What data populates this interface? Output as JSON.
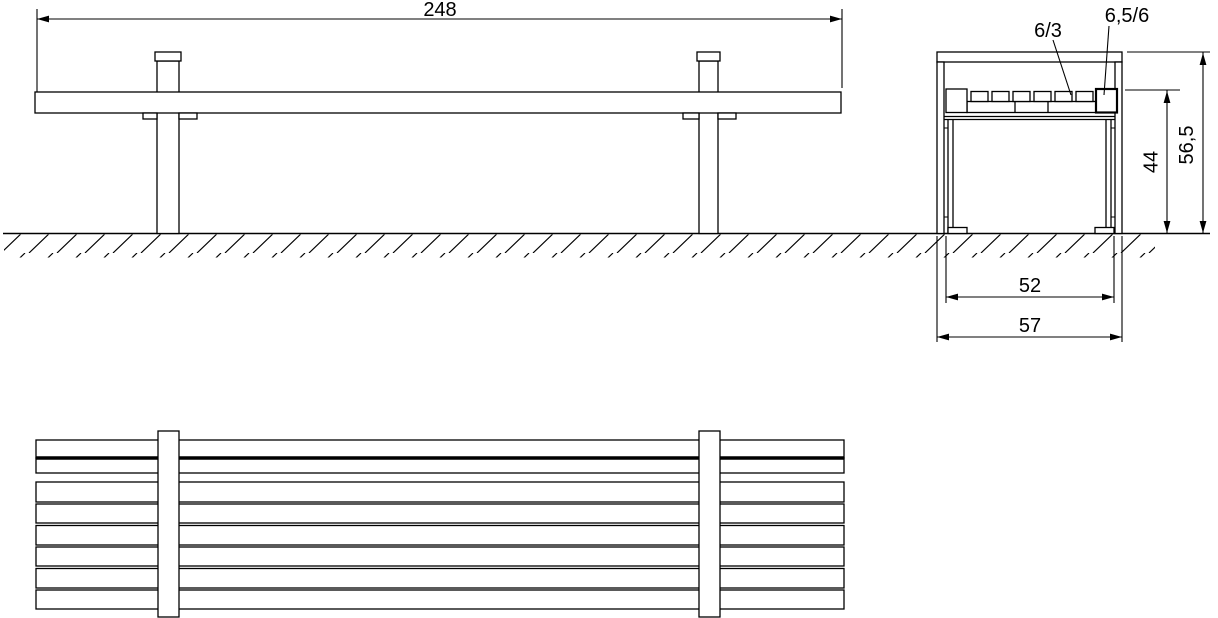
{
  "drawing": {
    "type": "bench-orthographic-technical-drawing",
    "views": [
      "front-elevation",
      "side-section",
      "top-view"
    ],
    "colors": {
      "line": "#000000",
      "background": "#ffffff"
    }
  },
  "dimensions": {
    "overall_length": "248",
    "middle_slat_section": "6/3",
    "end_slat_section": "6,5/6",
    "seat_height": "44",
    "overall_height": "56,5",
    "leg_span": "52",
    "overall_depth": "57"
  }
}
